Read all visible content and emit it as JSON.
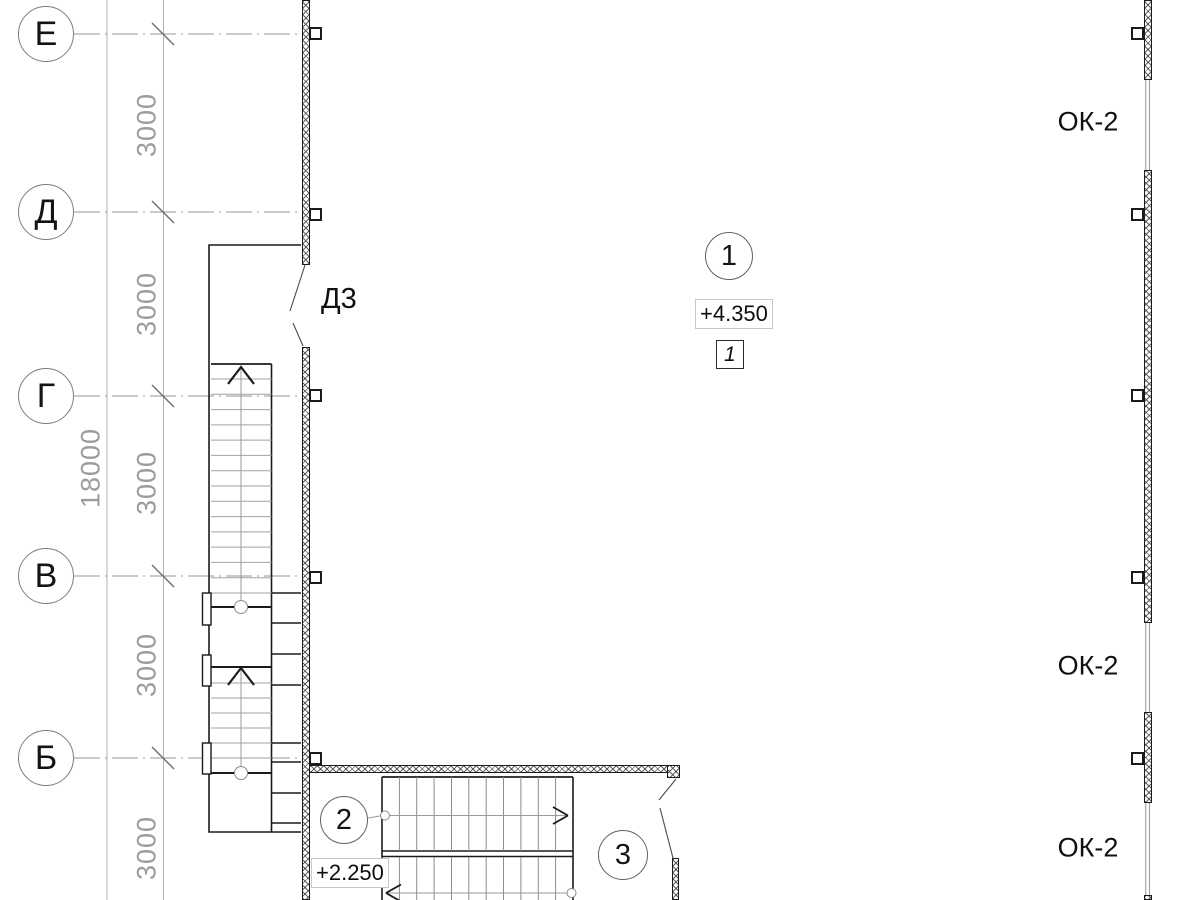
{
  "plan": {
    "axes": {
      "labels": [
        "Е",
        "Д",
        "Г",
        "В",
        "Б"
      ],
      "bay_dims": [
        "3000",
        "3000",
        "3000",
        "3000",
        "3000"
      ],
      "total_dim": "18000"
    },
    "doors": {
      "door_mark": "Д3"
    },
    "windows": {
      "marks": [
        "ОК-2",
        "ОК-2",
        "ОК-2"
      ]
    },
    "markers": {
      "positions": [
        "1",
        "2",
        "3"
      ],
      "section_flag": "1"
    },
    "levels": {
      "upper": "+4.350",
      "landing": "+2.250"
    },
    "colors": {
      "line_dark": "#1b1b1b",
      "line_thin": "#9c9c9c",
      "hatch_line": "#464646",
      "background": "#ffffff"
    }
  }
}
